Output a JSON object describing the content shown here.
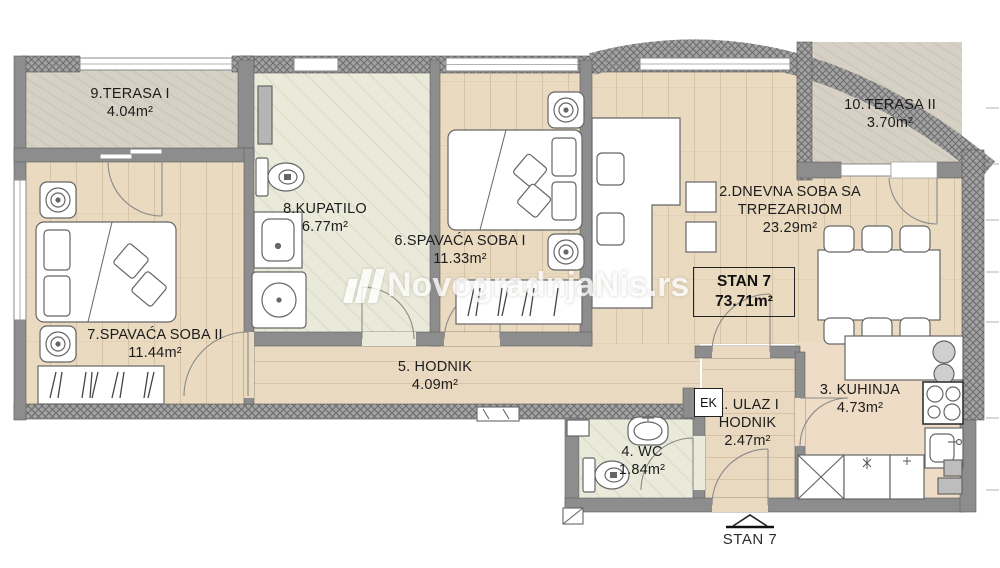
{
  "watermark": {
    "text": "NovogradnjaNis.rs"
  },
  "apartment": {
    "label": "STAN 7",
    "area": "73.71m²"
  },
  "footer": {
    "label": "STAN 7"
  },
  "labels": {
    "ek": "EK"
  },
  "rooms": {
    "ulaz": {
      "name": "1. ULAZ I",
      "name2": "HODNIK",
      "area": "2.47m²"
    },
    "dnevna": {
      "name": "2.DNEVNA SOBA SA",
      "name2": "TRPEZARIJOM",
      "area": "23.29m²"
    },
    "kuhinja": {
      "name": "3. KUHINJA",
      "area": "4.73m²"
    },
    "wc": {
      "name": "4. WC",
      "area": "1.84m²"
    },
    "hodnik": {
      "name": "5. HODNIK",
      "area": "4.09m²"
    },
    "spavaca1": {
      "name": "6.SPAVAĆA SOBA I",
      "area": "11.33m²"
    },
    "spavaca2": {
      "name": "7.SPAVAĆA SOBA II",
      "area": "11.44m²"
    },
    "kupatilo": {
      "name": "8.KUPATILO",
      "area": "6.77m²"
    },
    "terasa1": {
      "name": "9.TERASA I",
      "area": "4.04m²"
    },
    "terasa2": {
      "name": "10.TERASA II",
      "area": "3.70m²"
    }
  },
  "colors": {
    "wall_solid": "#8d8d8d",
    "wall_hatch_bg": "#a2a2a2",
    "wall_hatch_line": "#6b6b6b",
    "wood_floor": "#e9dac0",
    "tile_floor": "#eaeadb",
    "terrace_floor": "#d7d1c5",
    "kitchen_floor": "#eedcc6",
    "label_text": "#1c1c1c"
  }
}
